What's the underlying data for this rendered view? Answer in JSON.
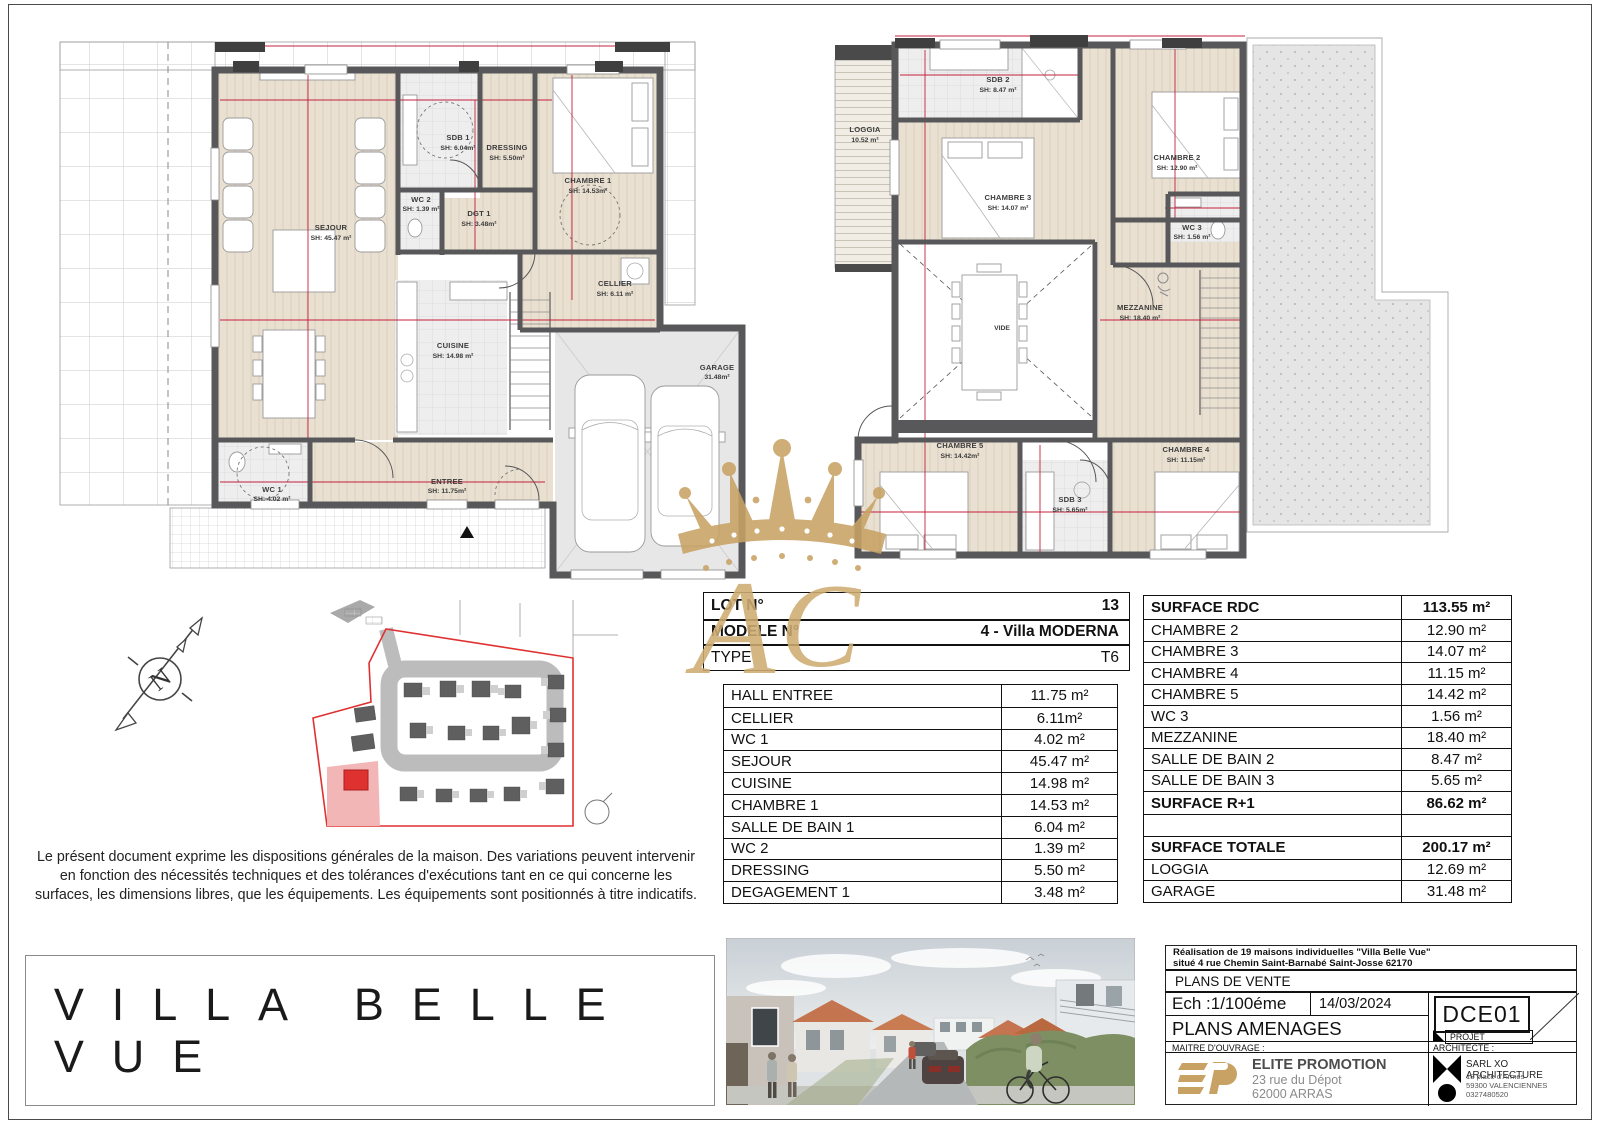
{
  "project_title": "VILLA BELLE VUE",
  "disclaimer": "Le présent document exprime les dispositions générales de la maison. Des variations peuvent intervenir en fonction des nécessités techniques et des tolérances d'exécutions tant en ce qui concerne les surfaces, les dimensions libres, que les équipements. Les équipements sont positionnés à titre indicatifs.",
  "compass": {
    "north": "N"
  },
  "plans": {
    "rdc": {
      "sejour": {
        "n": "SEJOUR",
        "a": "SH: 45.47 m²"
      },
      "sdb1": {
        "n": "SDB 1",
        "a": "SH: 6.04m²"
      },
      "dressing": {
        "n": "DRESSING",
        "a": "SH: 5.50m²"
      },
      "chambre1": {
        "n": "CHAMBRE 1",
        "a": "SH: 14.53m²"
      },
      "wc2": {
        "n": "WC 2",
        "a": "SH: 1.39 m²"
      },
      "dgt1": {
        "n": "DGT 1",
        "a": "SH: 3.48m²"
      },
      "cuisine": {
        "n": "CUISINE",
        "a": "SH: 14.98 m²"
      },
      "cellier": {
        "n": "CELLIER",
        "a": "SH: 6.11 m²"
      },
      "wc1": {
        "n": "WC 1",
        "a": "SH: 4.02 m²"
      },
      "entree": {
        "n": "ENTREE",
        "a": "SH: 11.75m²"
      },
      "garage": {
        "n": "GARAGE",
        "a": "31.48m²"
      }
    },
    "r1": {
      "loggia": {
        "n": "LOGGIA",
        "a": "10.52 m²"
      },
      "sdb2": {
        "n": "SDB 2",
        "a": "SH: 8.47 m²"
      },
      "chambre3": {
        "n": "CHAMBRE 3",
        "a": "SH: 14.07 m²"
      },
      "chambre2": {
        "n": "CHAMBRE 2",
        "a": "SH: 12.90 m²"
      },
      "wc3": {
        "n": "WC 3",
        "a": "SH: 1.56 m²"
      },
      "vide": {
        "n": "VIDE",
        "a": ""
      },
      "mezzanine": {
        "n": "MEZZANINE",
        "a": "SH: 18.40 m²"
      },
      "chambre5": {
        "n": "CHAMBRE 5",
        "a": "SH: 14.42m²"
      },
      "sdb3": {
        "n": "SDB 3",
        "a": "SH: 5.65m²"
      },
      "chambre4": {
        "n": "CHAMBRE 4",
        "a": "SH: 11.15m²"
      }
    }
  },
  "lot_table": {
    "rows": [
      {
        "label": "LOT N°",
        "value": "13"
      },
      {
        "label": "MODELE N°",
        "value": "4 - Villa MODERNA"
      },
      {
        "label": "TYPE",
        "value": "T6"
      }
    ]
  },
  "rdc_table": {
    "rows": [
      {
        "label": "HALL ENTREE",
        "value": "11.75 m²"
      },
      {
        "label": "CELLIER",
        "value": "6.11m²"
      },
      {
        "label": "WC 1",
        "value": "4.02 m²"
      },
      {
        "label": "SEJOUR",
        "value": "45.47 m²"
      },
      {
        "label": "CUISINE",
        "value": "14.98 m²"
      },
      {
        "label": "CHAMBRE 1",
        "value": "14.53 m²"
      },
      {
        "label": "SALLE DE BAIN 1",
        "value": "6.04 m²"
      },
      {
        "label": "WC 2",
        "value": "1.39 m²"
      },
      {
        "label": "DRESSING",
        "value": "5.50 m²"
      },
      {
        "label": "DEGAGEMENT 1",
        "value": "3.48 m²"
      }
    ]
  },
  "r1_table": {
    "rows": [
      {
        "label": "SURFACE RDC",
        "value": "113.55 m²"
      },
      {
        "label": "CHAMBRE 2",
        "value": "12.90 m²"
      },
      {
        "label": "CHAMBRE 3",
        "value": "14.07 m²"
      },
      {
        "label": "CHAMBRE 4",
        "value": "11.15 m²"
      },
      {
        "label": "CHAMBRE 5",
        "value": "14.42 m²"
      },
      {
        "label": "WC 3",
        "value": "1.56 m²"
      },
      {
        "label": "MEZZANINE",
        "value": "18.40 m²"
      },
      {
        "label": "SALLE DE BAIN 2",
        "value": "8.47 m²"
      },
      {
        "label": "SALLE DE BAIN 3",
        "value": "5.65 m²"
      },
      {
        "label": "SURFACE R+1",
        "value": "86.62 m²"
      },
      {
        "label": "",
        "value": ""
      },
      {
        "label": "SURFACE TOTALE",
        "value": "200.17 m²"
      },
      {
        "label": "LOGGIA",
        "value": "12.69 m²"
      },
      {
        "label": "GARAGE",
        "value": "31.48 m²"
      }
    ]
  },
  "title_block": {
    "project_line1": "Réalisation de 19 maisons individuelles \"Villa Belle Vue\"",
    "project_line2": "situé 4 rue Chemin Saint-Barnabé Saint-Josse 62170",
    "doc_type": "PLANS DE VENTE",
    "scale": "Ech :1/100éme",
    "date": "14/03/2024",
    "code": "DCE01",
    "sheet_name": "PLANS AMENAGES",
    "phase": "PROJET",
    "owner_label": "MAITRE D'OUVRAGE :",
    "architect_label": "ARCHITECTE :",
    "owner_name": "ELITE PROMOTION",
    "owner_addr1": "23 rue du Dépot",
    "owner_addr2": "62000 ARRAS",
    "architect_name": "SARL XO ARCHITECTURE",
    "architect_addr1": "18 place d'Armes",
    "architect_addr2": "59300 VALENCIENNES",
    "architect_phone": "0327480520"
  },
  "colors": {
    "accent_red": "#c5203c",
    "gold": "#c8a264",
    "wall_gray": "#58585a",
    "site_red": "#e03131"
  }
}
